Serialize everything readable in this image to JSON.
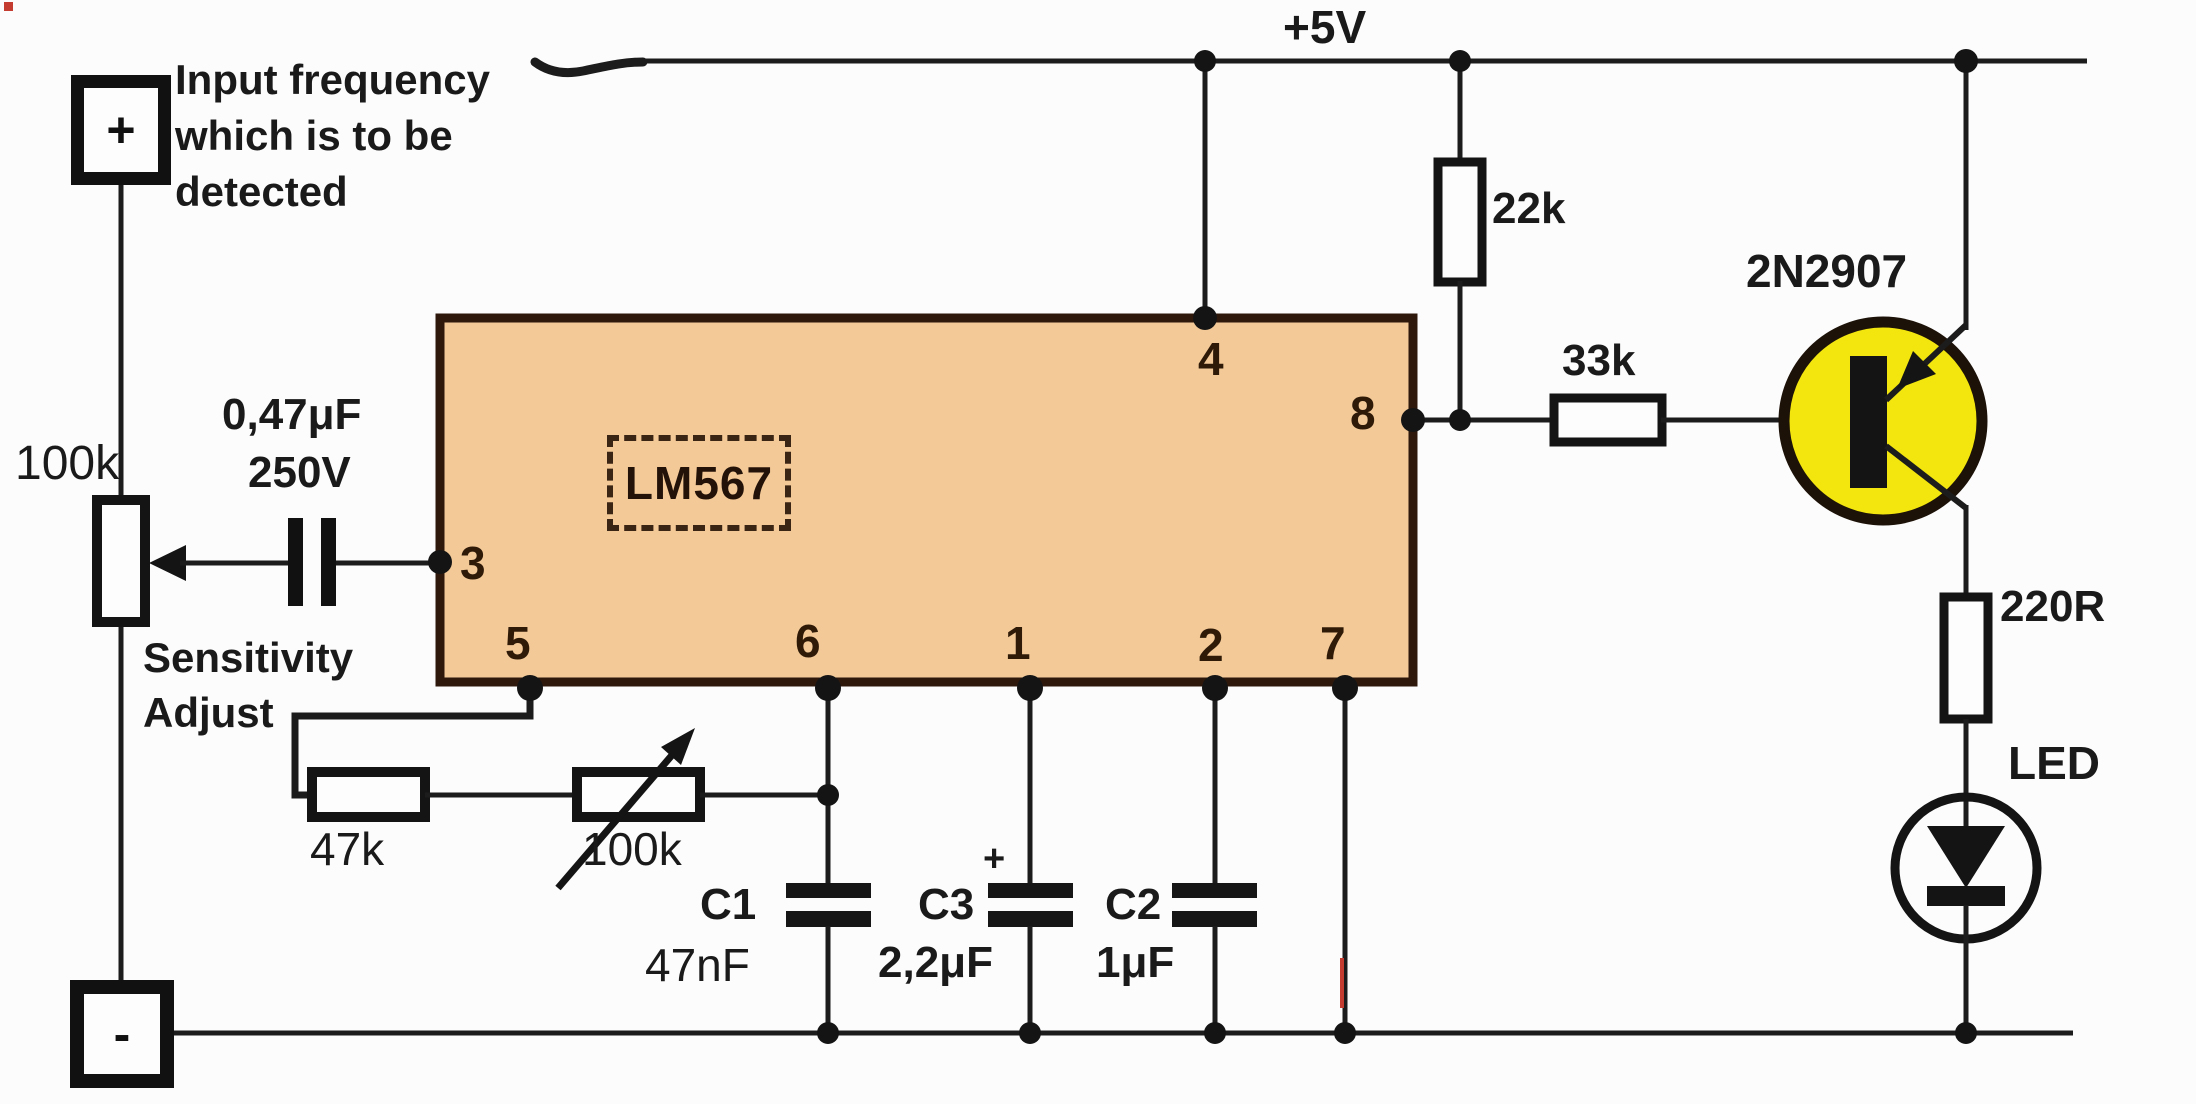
{
  "supply": {
    "label": "+5V"
  },
  "terminals": {
    "positive": "+",
    "negative": "-"
  },
  "annotations": {
    "input_note": [
      "Input frequency",
      "which is to be",
      "detected"
    ],
    "sensitivity": [
      "Sensitivity",
      "Adjust"
    ]
  },
  "components": {
    "pot_input": {
      "value": "100k"
    },
    "cap_coupling": {
      "value": "0,47μF",
      "voltage": "250V"
    },
    "ic": {
      "part": "LM567",
      "pins": {
        "p1": "1",
        "p2": "2",
        "p3": "3",
        "p4": "4",
        "p5": "5",
        "p6": "6",
        "p7": "7",
        "p8": "8"
      }
    },
    "r_22k": {
      "value": "22k"
    },
    "r_33k": {
      "value": "33k"
    },
    "transistor": {
      "part": "2N2907"
    },
    "r_220": {
      "value": "220R"
    },
    "led": {
      "label": "LED"
    },
    "r_47k": {
      "value": "47k"
    },
    "rheostat": {
      "value": "100k"
    },
    "c1": {
      "name": "C1",
      "value": "47nF"
    },
    "c3": {
      "name": "C3",
      "value": "2,2μF",
      "polarity": "+"
    },
    "c2": {
      "name": "C2",
      "value": "1μF"
    }
  },
  "colors": {
    "ic_fill": "#f3c997",
    "ic_border": "#2e180c",
    "transistor_fill": "#f2e60e",
    "wire": "#1c1c1c",
    "background": "#fcfcfc",
    "artifact_red": "#c43b30"
  }
}
